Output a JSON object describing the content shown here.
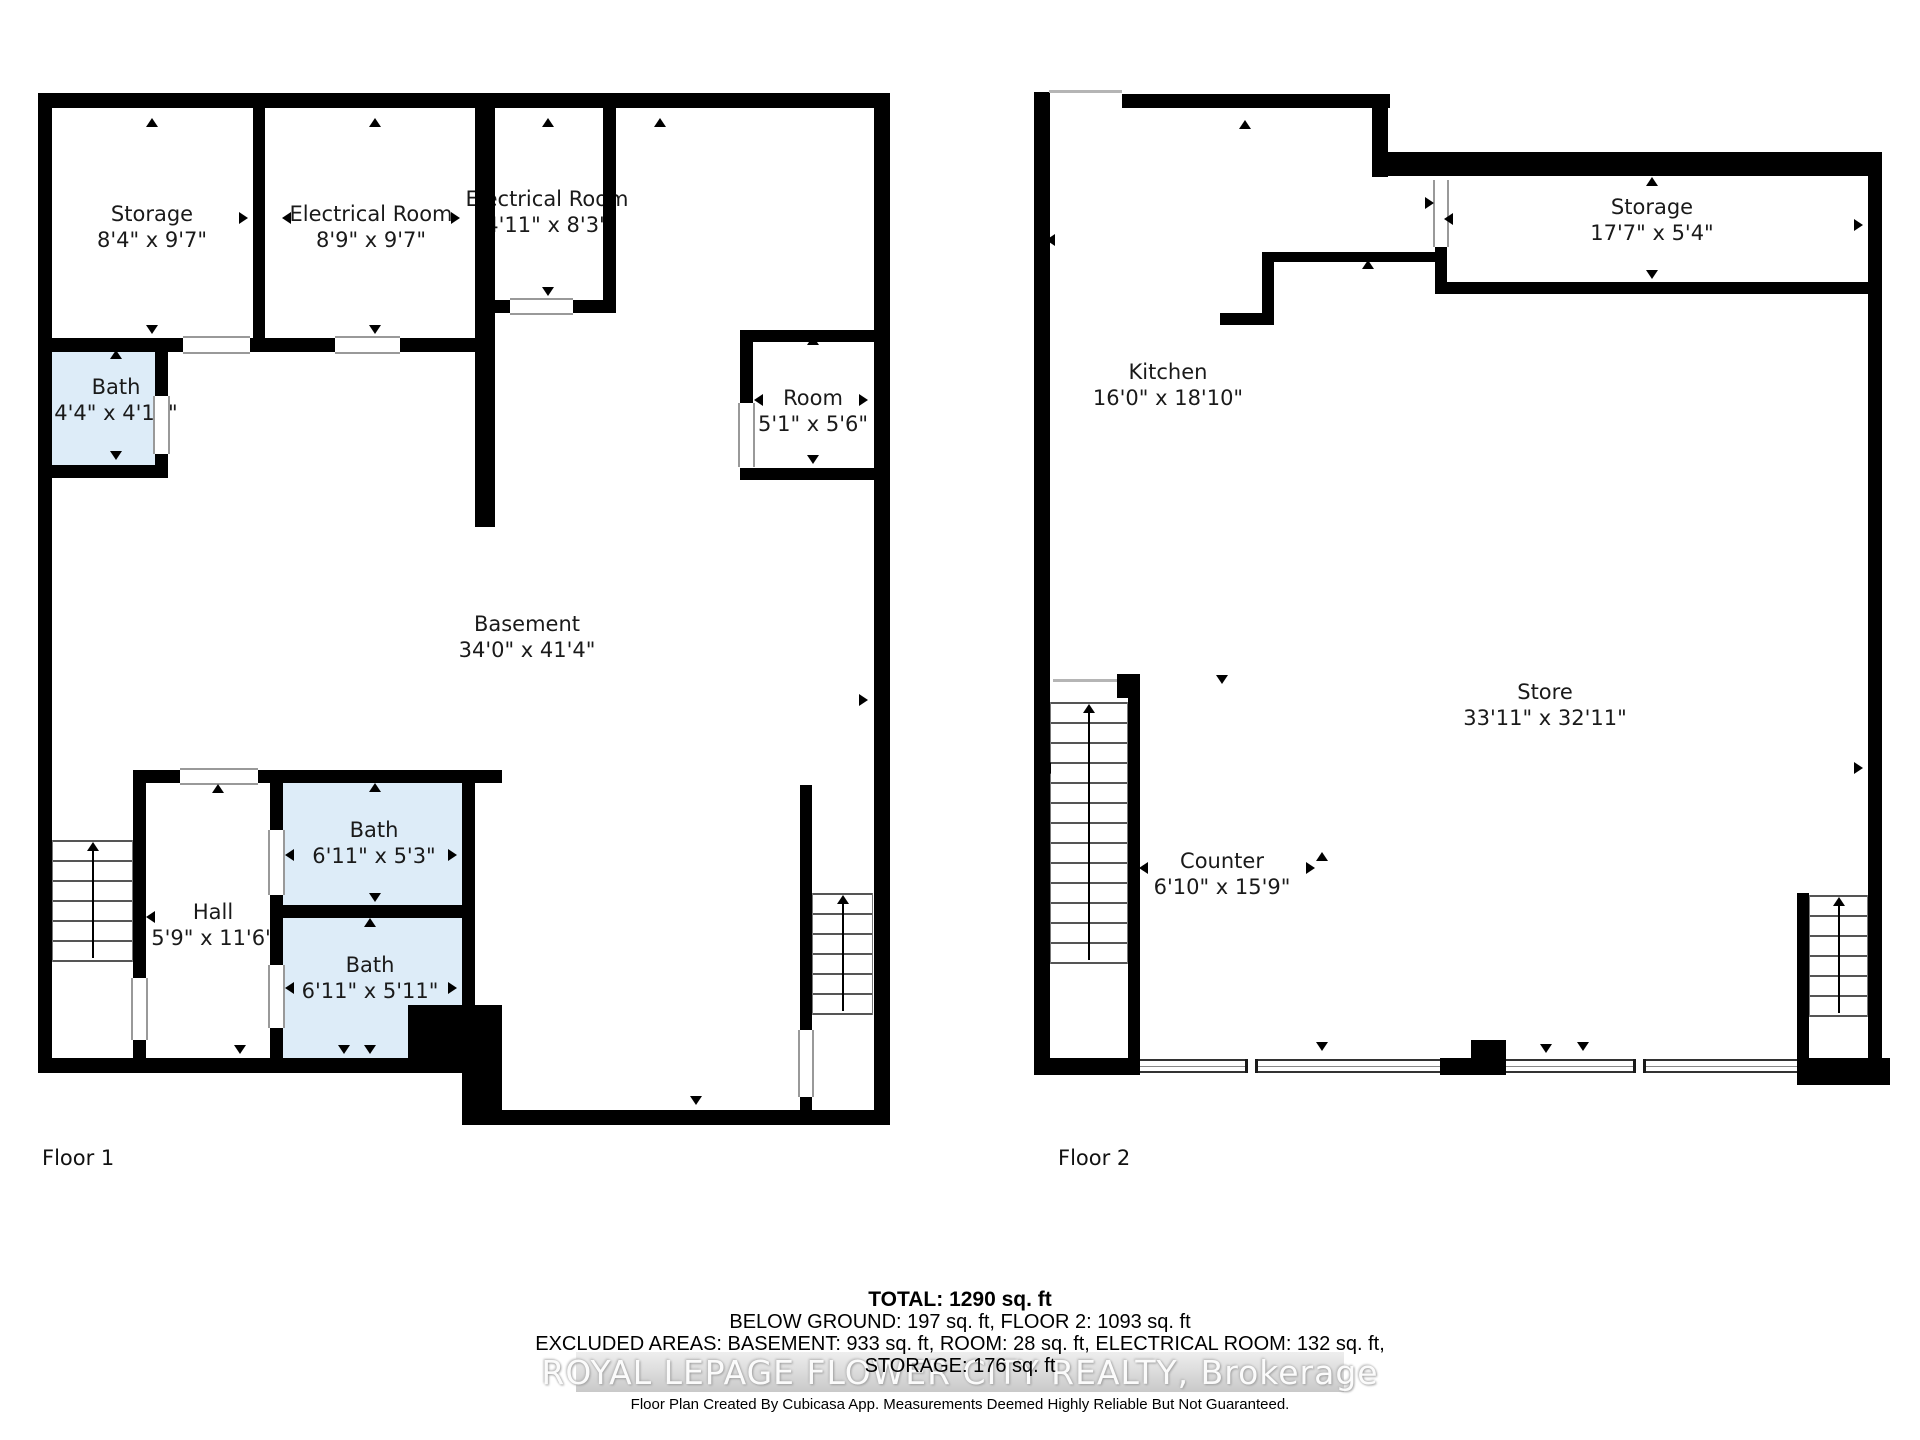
{
  "floors": {
    "floor1_label": "Floor 1",
    "floor2_label": "Floor 2"
  },
  "rooms": [
    {
      "id": "storage-f1",
      "floor": 1,
      "name": "Storage",
      "dims": "8'4\" x 9'7\"",
      "cx": 152,
      "cy": 227
    },
    {
      "id": "electrical-room-f1",
      "floor": 1,
      "name": "Electrical Room",
      "dims": "8'9\" x 9'7\"",
      "cx": 371,
      "cy": 227
    },
    {
      "id": "electrical-room-2-f1",
      "floor": 1,
      "name": "Electrical Room",
      "dims": "4'11\" x 8'3\"",
      "cx": 547,
      "cy": 212
    },
    {
      "id": "bath-f1",
      "floor": 1,
      "name": "Bath",
      "dims": "4'4\" x 4'11\"",
      "cx": 116,
      "cy": 400
    },
    {
      "id": "room-f1",
      "floor": 1,
      "name": "Room",
      "dims": "5'1\" x 5'6\"",
      "cx": 813,
      "cy": 411
    },
    {
      "id": "basement-f1",
      "floor": 1,
      "name": "Basement",
      "dims": "34'0\" x 41'4\"",
      "cx": 527,
      "cy": 637
    },
    {
      "id": "hall-f1",
      "floor": 1,
      "name": "Hall",
      "dims": "5'9\" x 11'6\"",
      "cx": 213,
      "cy": 925
    },
    {
      "id": "bath-1-f1",
      "floor": 1,
      "name": "Bath",
      "dims": "6'11\" x 5'3\"",
      "cx": 374,
      "cy": 843
    },
    {
      "id": "bath-2-f1",
      "floor": 1,
      "name": "Bath",
      "dims": "6'11\" x 5'11\"",
      "cx": 370,
      "cy": 978
    },
    {
      "id": "kitchen-f2",
      "floor": 2,
      "name": "Kitchen",
      "dims": "16'0\" x 18'10\"",
      "cx": 1168,
      "cy": 385
    },
    {
      "id": "storage-f2",
      "floor": 2,
      "name": "Storage",
      "dims": "17'7\" x 5'4\"",
      "cx": 1652,
      "cy": 220
    },
    {
      "id": "store-f2",
      "floor": 2,
      "name": "Store",
      "dims": "33'11\" x 32'11\"",
      "cx": 1545,
      "cy": 705
    },
    {
      "id": "counter-f2",
      "floor": 2,
      "name": "Counter",
      "dims": "6'10\" x 15'9\"",
      "cx": 1222,
      "cy": 874
    }
  ],
  "footer": {
    "total": "TOTAL: 1290 sq. ft",
    "line2": "BELOW GROUND: 197 sq. ft, FLOOR 2: 1093 sq. ft",
    "line3": "EXCLUDED AREAS: BASEMENT: 933 sq. ft, ROOM: 28 sq. ft, ELECTRICAL ROOM: 132 sq. ft,",
    "line4": "STORAGE: 176 sq. ft",
    "watermark": "ROYAL LEPAGE FLOWER CITY REALTY, Brokerage",
    "disclaimer": "Floor Plan Created By Cubicasa App. Measurements Deemed Highly Reliable But Not Guaranteed."
  },
  "colors": {
    "bath_fill": "#ddecf8",
    "wall": "#000000"
  }
}
